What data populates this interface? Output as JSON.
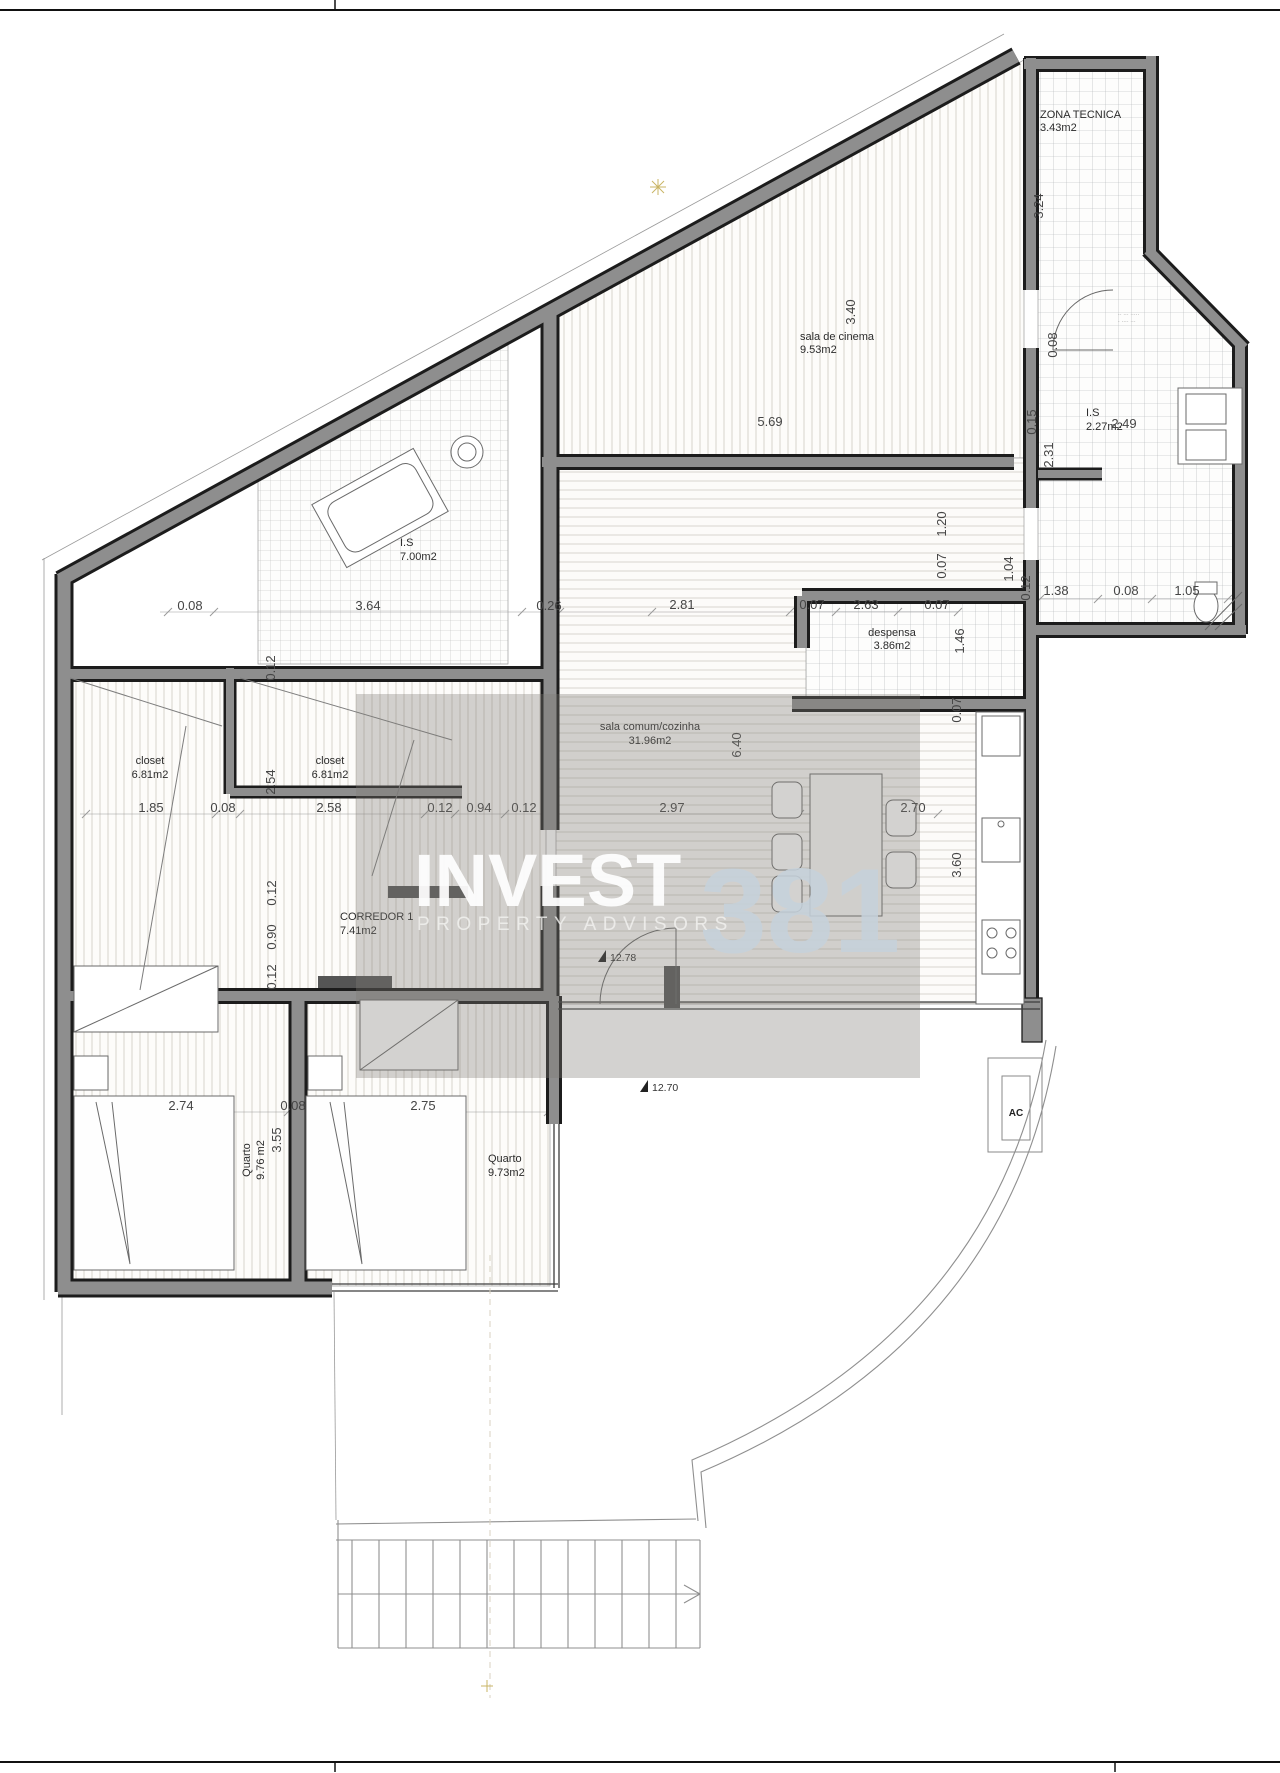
{
  "drawing": {
    "watermark": {
      "brand": "INVEST",
      "number": "381",
      "tagline": "PROPERTY ADVISORS"
    },
    "rooms": {
      "zona_tecnica": {
        "name": "ZONA TECNICA",
        "area": "3.43m2"
      },
      "sala_cinema": {
        "name": "sala de cinema",
        "area": "9.53m2"
      },
      "is_grande": {
        "name": "I.S",
        "area": "7.00m2"
      },
      "is_pequena": {
        "name": "I.S",
        "area": "2.27m2"
      },
      "despensa": {
        "name": "despensa",
        "area": "3.86m2"
      },
      "sala_comum": {
        "name": "sala comum/cozinha",
        "area": "31.96m2"
      },
      "closet_1": {
        "name": "closet",
        "area": "6.81m2"
      },
      "closet_2": {
        "name": "closet",
        "area": "6.81m2"
      },
      "corredor_1": {
        "name": "CORREDOR 1",
        "area": "7.41m2"
      },
      "quarto_1": {
        "name": "Quarto",
        "area": "9.76 m2"
      },
      "quarto_2": {
        "name": "Quarto",
        "area": "9.73m2"
      }
    },
    "equipment": {
      "ac": "AC"
    },
    "levels": {
      "upper": "12.78",
      "lower": "12.70"
    },
    "small_note": {
      "line1": "·· ··· ·····",
      "line2": "· ···· ···"
    },
    "dims": [
      "3.24",
      "3.40",
      "5.69",
      "0.15",
      "2.31",
      "2.49",
      "0.08",
      "0.08",
      "3.64",
      "0.26",
      "2.81",
      "0.07",
      "2.63",
      "0.07",
      "1.04",
      "0.12",
      "1.38",
      "0.08",
      "1.05",
      "1.20",
      "1.46",
      "0.07",
      "0.07",
      "6.40",
      "3.60",
      "0.12",
      "2.54",
      "1.85",
      "0.08",
      "2.58",
      "0.12",
      "0.94",
      "0.12",
      "2.97",
      "2.70",
      "0.12",
      "0.90",
      "0.12",
      "2.74",
      "0.08",
      "2.75",
      "3.55"
    ],
    "colors": {
      "wall_fill": "#8e8e8e",
      "wall_edge": "#1c1c1c",
      "accent_guide": "#c9b464"
    }
  }
}
